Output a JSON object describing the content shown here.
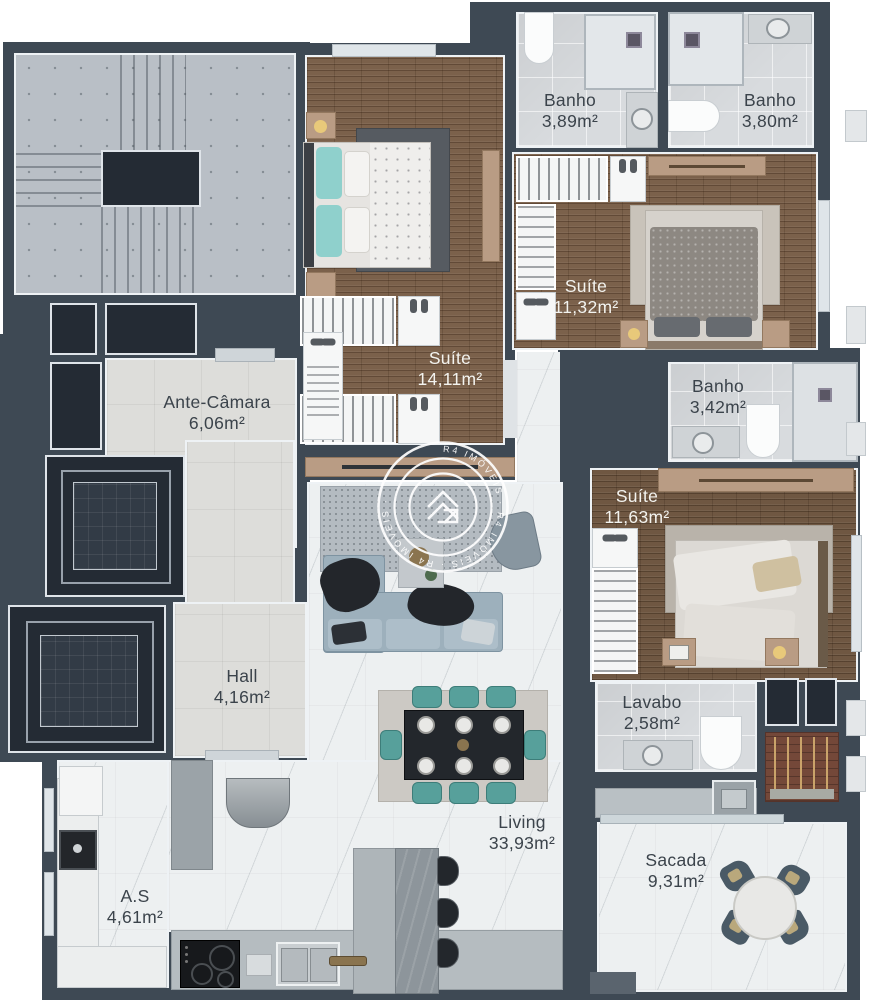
{
  "title": "Apartment floor plan",
  "rooms": {
    "banho_389": {
      "name": "Banho",
      "area": "3,89m²"
    },
    "banho_380": {
      "name": "Banho",
      "area": "3,80m²"
    },
    "suite_1132": {
      "name": "Suíte",
      "area": "11,32m²"
    },
    "suite_1411": {
      "name": "Suíte",
      "area": "14,11m²"
    },
    "ante_camara": {
      "name": "Ante-Câmara",
      "area": "6,06m²"
    },
    "banho_342": {
      "name": "Banho",
      "area": "3,42m²"
    },
    "suite_1163": {
      "name": "Suíte",
      "area": "11,63m²"
    },
    "hall": {
      "name": "Hall",
      "area": "4,16m²"
    },
    "lavabo": {
      "name": "Lavabo",
      "area": "2,58m²"
    },
    "living": {
      "name": "Living",
      "area": "33,93m²"
    },
    "sacada": {
      "name": "Sacada",
      "area": "9,31m²"
    },
    "as": {
      "name": "A.S",
      "area": "4,61m²"
    }
  },
  "watermark": {
    "brand": "R4 IMÓVEIS",
    "ring_text": "R4 IMÓVEIS · R4 IMÓVEIS · R4 IMÓVEIS ·"
  },
  "colors": {
    "wall": "#3e4954",
    "wood_floor": "#7b614b",
    "tile_floor": "#d8dbde",
    "marble_floor": "#edf0f1",
    "accent_teal": "#57a09b"
  }
}
